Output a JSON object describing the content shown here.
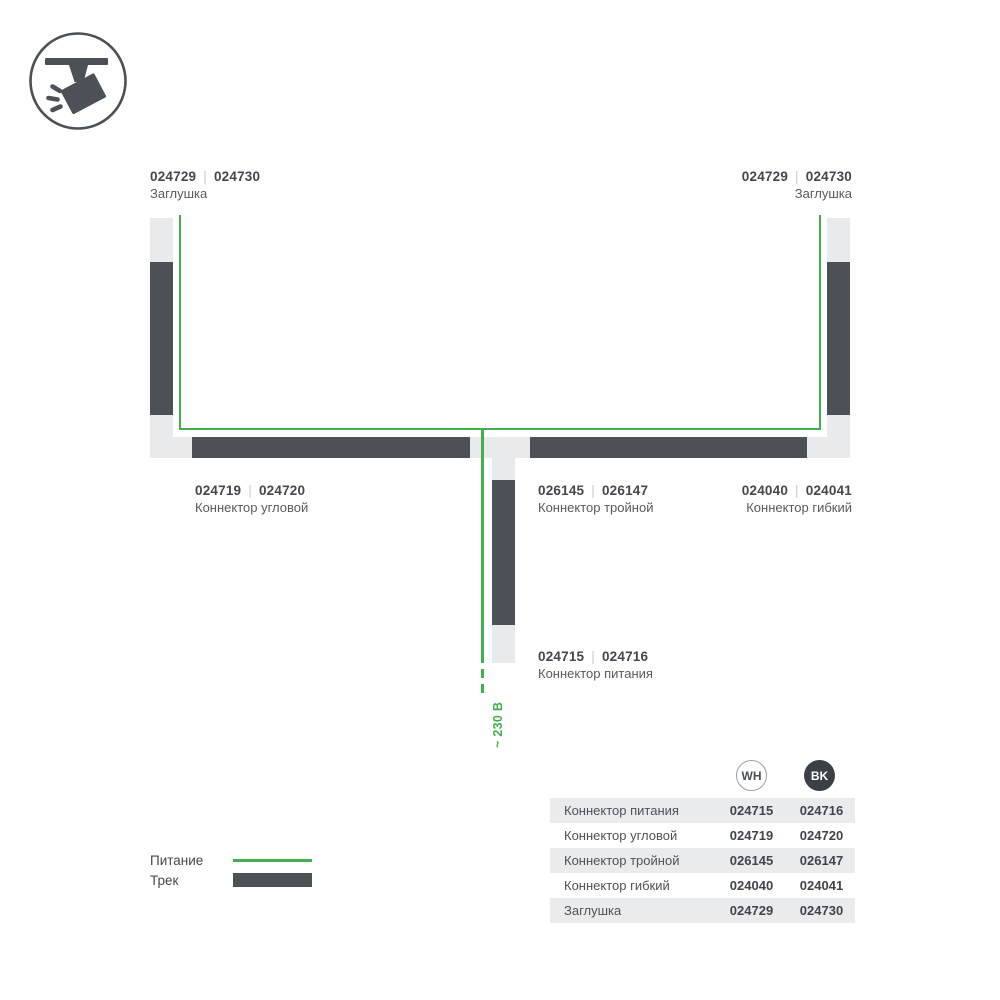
{
  "colors": {
    "accent_green": "#41b04d",
    "track_dark": "#4b5157",
    "connector_light": "#e9eaeb"
  },
  "diagram": {
    "separator": "|",
    "voltage": "~ 230 В",
    "endcap_left": {
      "code_wh": "024729",
      "code_bk": "024730",
      "name": "Заглушка"
    },
    "endcap_right": {
      "code_wh": "024729",
      "code_bk": "024730",
      "name": "Заглушка"
    },
    "corner": {
      "code_wh": "024719",
      "code_bk": "024720",
      "name": "Коннектор угловой"
    },
    "triple": {
      "code_wh": "026145",
      "code_bk": "026147",
      "name": "Коннектор тройной"
    },
    "flexible": {
      "code_wh": "024040",
      "code_bk": "024041",
      "name": "Коннектор гибкий"
    },
    "power": {
      "code_wh": "024715",
      "code_bk": "024716",
      "name": "Коннектор питания"
    }
  },
  "legend": {
    "power": "Питание",
    "track": "Трек"
  },
  "table": {
    "col_wh": "WH",
    "col_bk": "BK",
    "rows": [
      {
        "name": "Коннектор питания",
        "wh": "024715",
        "bk": "024716"
      },
      {
        "name": "Коннектор угловой",
        "wh": "024719",
        "bk": "024720"
      },
      {
        "name": "Коннектор тройной",
        "wh": "026145",
        "bk": "026147"
      },
      {
        "name": "Коннектор гибкий",
        "wh": "024040",
        "bk": "024041"
      },
      {
        "name": "Заглушка",
        "wh": "024729",
        "bk": "024730"
      }
    ]
  }
}
